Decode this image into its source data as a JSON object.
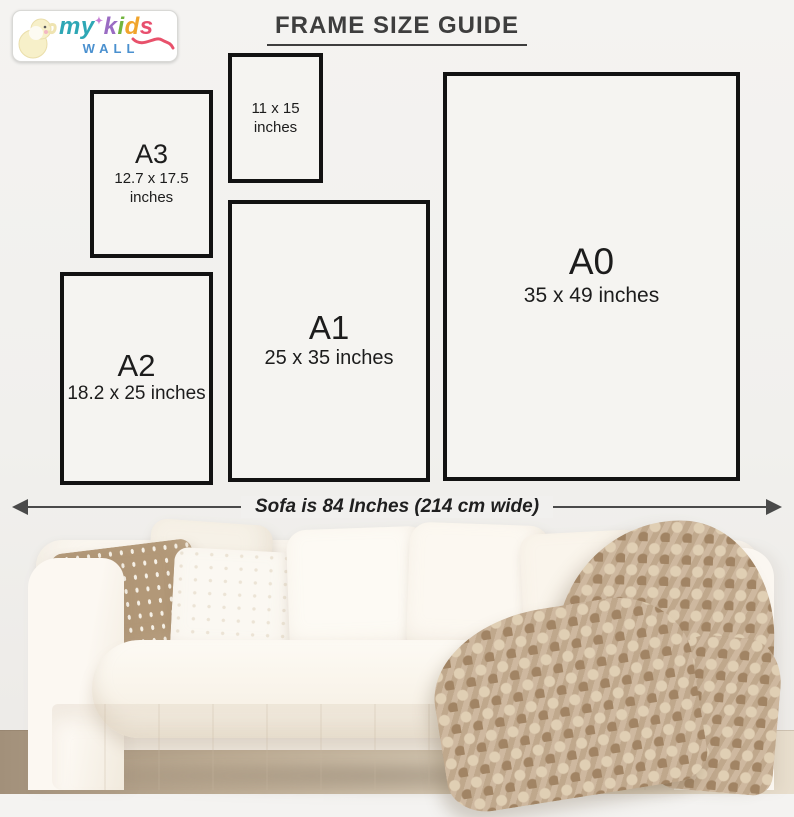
{
  "logo": {
    "my": "my",
    "star": "✦",
    "kids": [
      "k",
      "i",
      "d",
      "s"
    ],
    "wall": "WALL",
    "colors": {
      "my": "#2ea7b5",
      "star": "#c77fd4",
      "k": "#9a6cc3",
      "i": "#72b53e",
      "d": "#f0a42c",
      "s": "#e84f6e",
      "swoosh": "#e8516b",
      "wall": "#4a90cf",
      "elephant": "#f7f0c9"
    }
  },
  "header": {
    "title": "FRAME SIZE GUIDE"
  },
  "frames": [
    {
      "label": "A3",
      "line1": "12.7 x 17.5",
      "line2": "inches"
    },
    {
      "label": "",
      "line1": "11 x 15",
      "line2": "inches"
    },
    {
      "label": "A2",
      "line1": "18.2 x 25 inches",
      "line2": ""
    },
    {
      "label": "A1",
      "line1": "25 x 35 inches",
      "line2": ""
    },
    {
      "label": "A0",
      "line1": "35 x 49 inches",
      "line2": ""
    }
  ],
  "measurement": {
    "label": "Sofa is 84 Inches (214 cm wide)"
  },
  "scene": {
    "description": "white slipcovered sofa with cream pillows, one beige patterned pillow, chunky knit beige blanket draped on right arm",
    "colors": {
      "wall": "#f1f0ed",
      "frame_border": "#121212",
      "frame_fill": "#f5f4f1",
      "title_text": "#3e3e3e",
      "measure_line": "#4a4a4a",
      "sofa": "#faf6ef",
      "patterned_pillow": "#b29878",
      "blanket": "#c8b094",
      "floor_left": "#a2907a",
      "floor_right": "#e8decd"
    }
  }
}
